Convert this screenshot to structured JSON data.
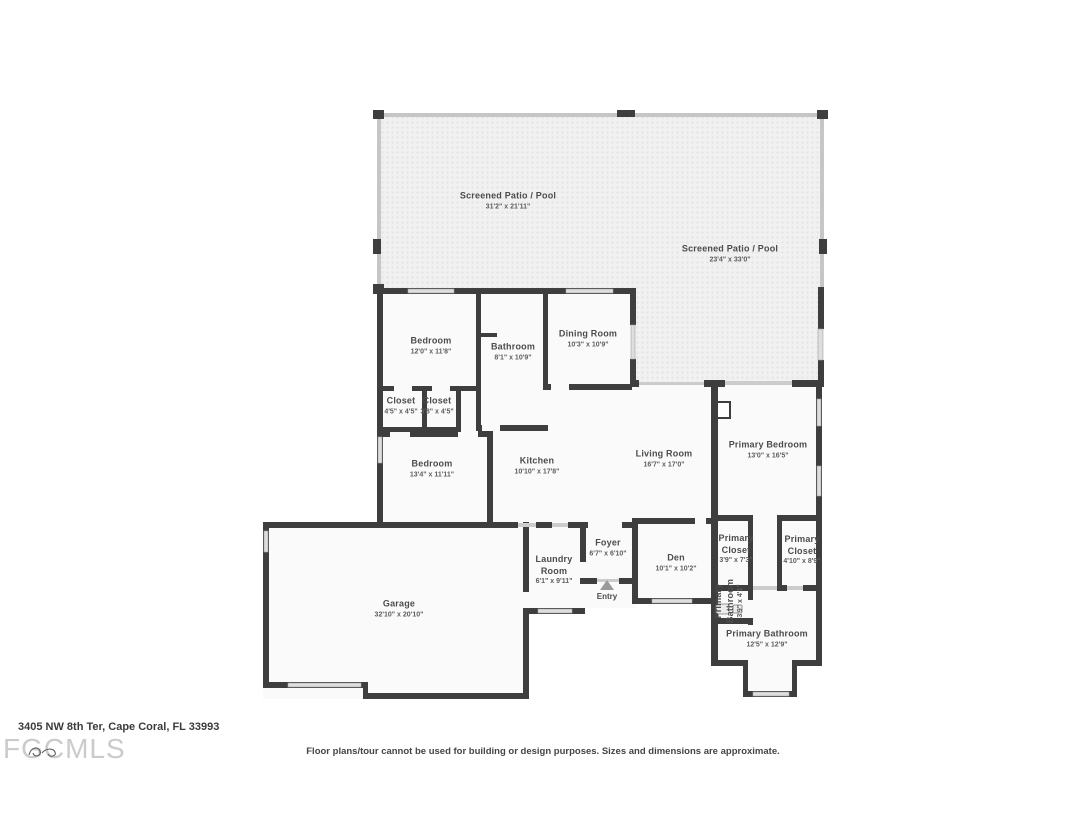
{
  "floor_plan": {
    "rooms": [
      {
        "name": "Screened Patio / Pool",
        "dims": "31'2\" x 21'11\""
      },
      {
        "name": "Screened Patio / Pool",
        "dims": "23'4\" x 33'0\""
      },
      {
        "name": "Bedroom",
        "dims": "12'0\" x 11'8\""
      },
      {
        "name": "Bathroom",
        "dims": "8'1\" x 10'9\""
      },
      {
        "name": "Dining Room",
        "dims": "10'3\" x 10'9\""
      },
      {
        "name": "Closet",
        "dims": "4'5\" x 4'5\""
      },
      {
        "name": "Closet",
        "dims": "3'8\" x 4'5\""
      },
      {
        "name": "Bedroom",
        "dims": "13'4\" x 11'11\""
      },
      {
        "name": "Kitchen",
        "dims": "10'10\" x 17'8\""
      },
      {
        "name": "Living Room",
        "dims": "16'7\" x 17'0\""
      },
      {
        "name": "Primary Bedroom",
        "dims": "13'0\" x 16'5\""
      },
      {
        "name": "Foyer",
        "dims": "6'7\" x 6'10\""
      },
      {
        "name": "Laundry Room",
        "dims": "6'1\" x 9'11\""
      },
      {
        "name": "Den",
        "dims": "10'1\" x 10'2\""
      },
      {
        "name": "Primary Closet",
        "dims": "3'9\" x 7'3\""
      },
      {
        "name": "Primary Closet",
        "dims": "4'10\" x 8'9\""
      },
      {
        "name": "Primary Bathroom",
        "dims": "3'9\" x 4'1\""
      },
      {
        "name": "Primary Bathroom",
        "dims": "12'5\" x 12'9\""
      },
      {
        "name": "Garage",
        "dims": "32'10\" x 20'10\""
      },
      {
        "name": "Entry"
      }
    ]
  },
  "footer": {
    "address": "3405 NW 8th Ter, Cape Coral, FL 33993",
    "watermark": "FGCMLS",
    "disclaimer": "Floor plans/tour cannot be used for building or design purposes. Sizes and dimensions are approximate."
  },
  "colors": {
    "wall": "#3e3e3e",
    "screen_wall": "#c6c6c6",
    "window": "#dedede",
    "door": "#cccccc",
    "patio_fill": "#f1f1f1",
    "patio_dot": "#e3e3e3",
    "room_fill": "#fafafa",
    "label_text": "#4c4c4c",
    "watermark_text": "#cbcbcb"
  }
}
